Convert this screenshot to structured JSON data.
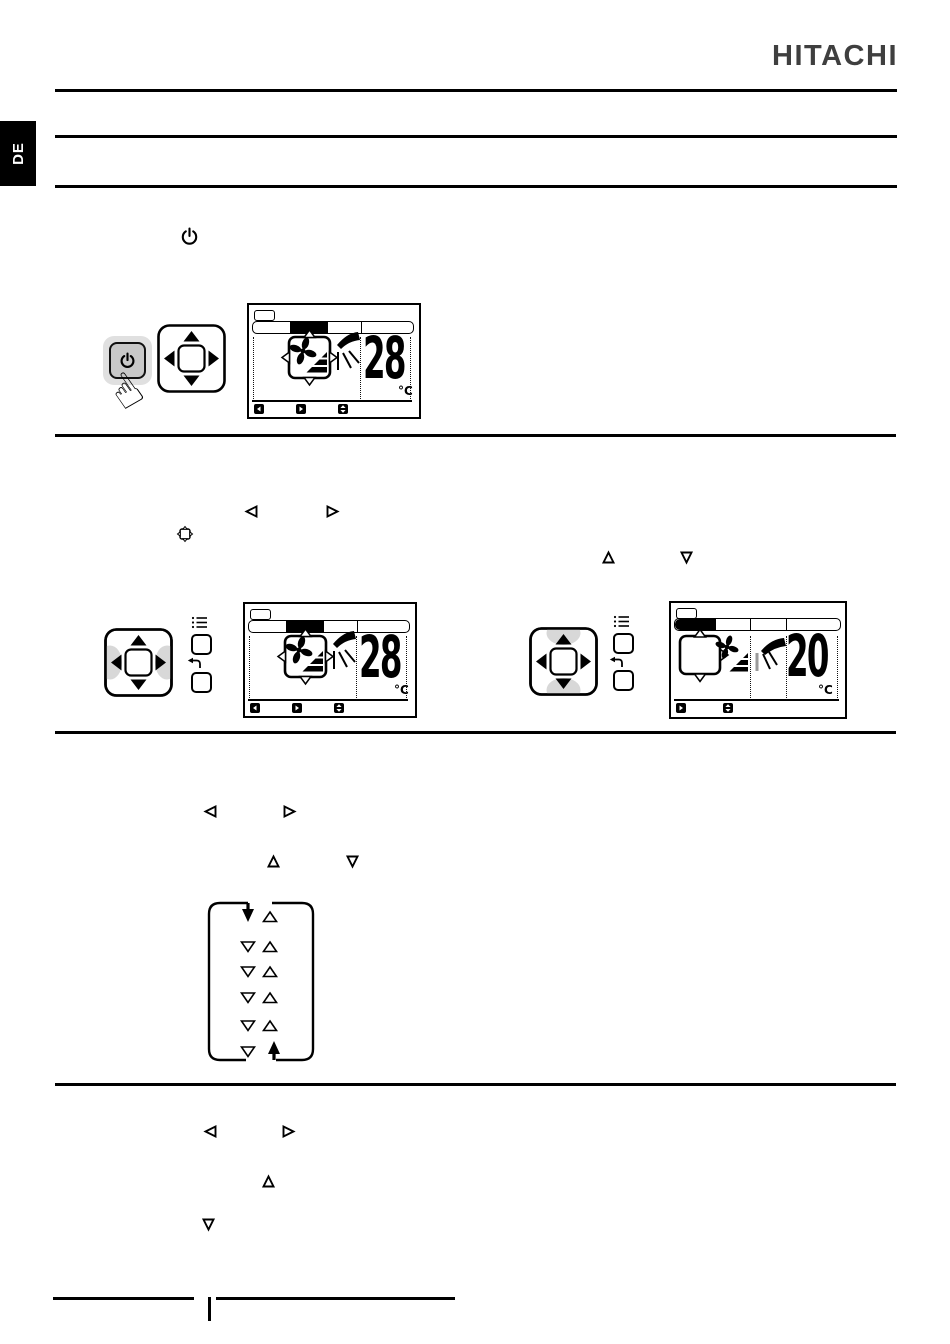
{
  "page": {
    "brand_logo": "HITACHI",
    "language_tab": "DE"
  },
  "colors": {
    "ink": "#000000",
    "logo_gray": "#3f3f3f",
    "button_fill": "#c8c8c8",
    "button_halo": "#e0e0e0",
    "highlight": "#d8d8d8",
    "ray_gray": "#9a9a9a"
  },
  "section1": {
    "inline_icons": [
      "power-icon"
    ],
    "remote": {
      "buttons": [
        "power-button",
        "dpad-up",
        "dpad-down",
        "dpad-left",
        "dpad-right",
        "dpad-center"
      ]
    },
    "display": {
      "temperature": "28",
      "unit": "°C",
      "mode_icon": "fan-with-louver-in-cursor-frame",
      "airflow_icon": "airflow-swing",
      "softkeys": [
        "left-arrow-key",
        "right-arrow-key",
        "up-down-key"
      ]
    }
  },
  "section2": {
    "left": {
      "inline_icons": [
        "left-triangle-icon",
        "right-triangle-icon",
        "cursor-frame-icon"
      ],
      "remote": {
        "highlighted": "left-right",
        "side_buttons": [
          "menu-button",
          "return-button"
        ]
      },
      "display": {
        "temperature": "28",
        "unit": "°C",
        "softkeys": [
          "left-arrow-key",
          "right-arrow-key",
          "up-down-key"
        ]
      }
    },
    "right": {
      "inline_icons": [
        "up-triangle-icon",
        "down-triangle-icon"
      ],
      "remote": {
        "highlighted": "up-down",
        "side_buttons": [
          "menu-button",
          "return-button"
        ]
      },
      "display": {
        "temperature": "20",
        "unit": "°C",
        "softkeys": [
          "right-arrow-key",
          "up-down-key"
        ]
      }
    }
  },
  "section3": {
    "inline_icons": [
      "left-triangle-icon",
      "right-triangle-icon",
      "up-triangle-icon",
      "down-triangle-icon"
    ],
    "cycle_diagram": {
      "rows": 6,
      "left_column": "down-triangles",
      "right_column": "up-triangles",
      "top_left": "down-arrow-filled",
      "bottom_right": "up-arrow-filled",
      "meaning": "value wraps around in a loop"
    }
  },
  "section4": {
    "inline_icons": [
      "left-triangle-icon",
      "right-triangle-icon",
      "up-triangle-icon",
      "down-triangle-icon"
    ]
  }
}
